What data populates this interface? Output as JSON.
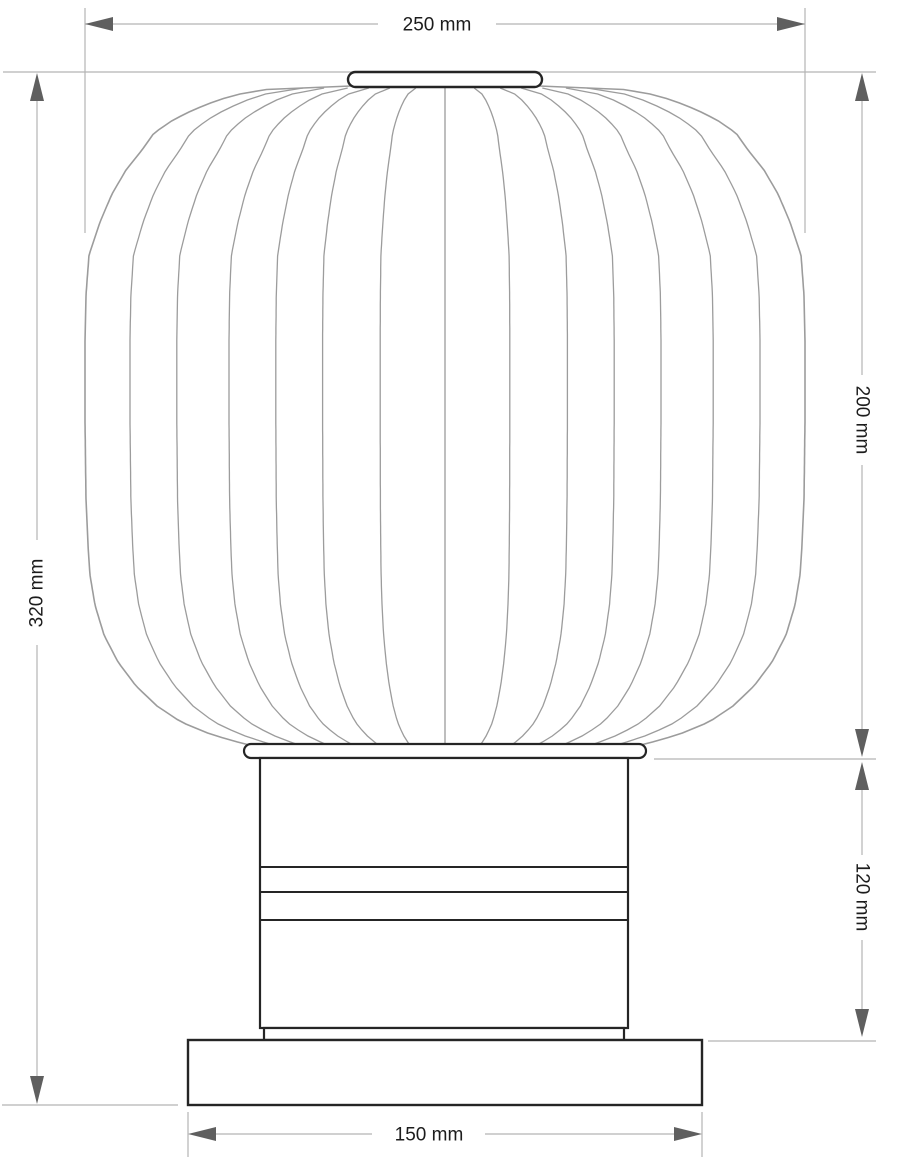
{
  "drawing": {
    "dimensions": {
      "overall_width": "250 mm",
      "overall_height": "320 mm",
      "shade_height": "200 mm",
      "pedestal_height": "120 mm",
      "base_width": "150 mm"
    },
    "colors": {
      "background": "#ffffff",
      "part_outline": "#252525",
      "shade_line": "#9c9c9c",
      "dimension_line": "#b4b4b4",
      "arrow": "#5f5f5f",
      "label_text": "#1c1c1c"
    }
  }
}
